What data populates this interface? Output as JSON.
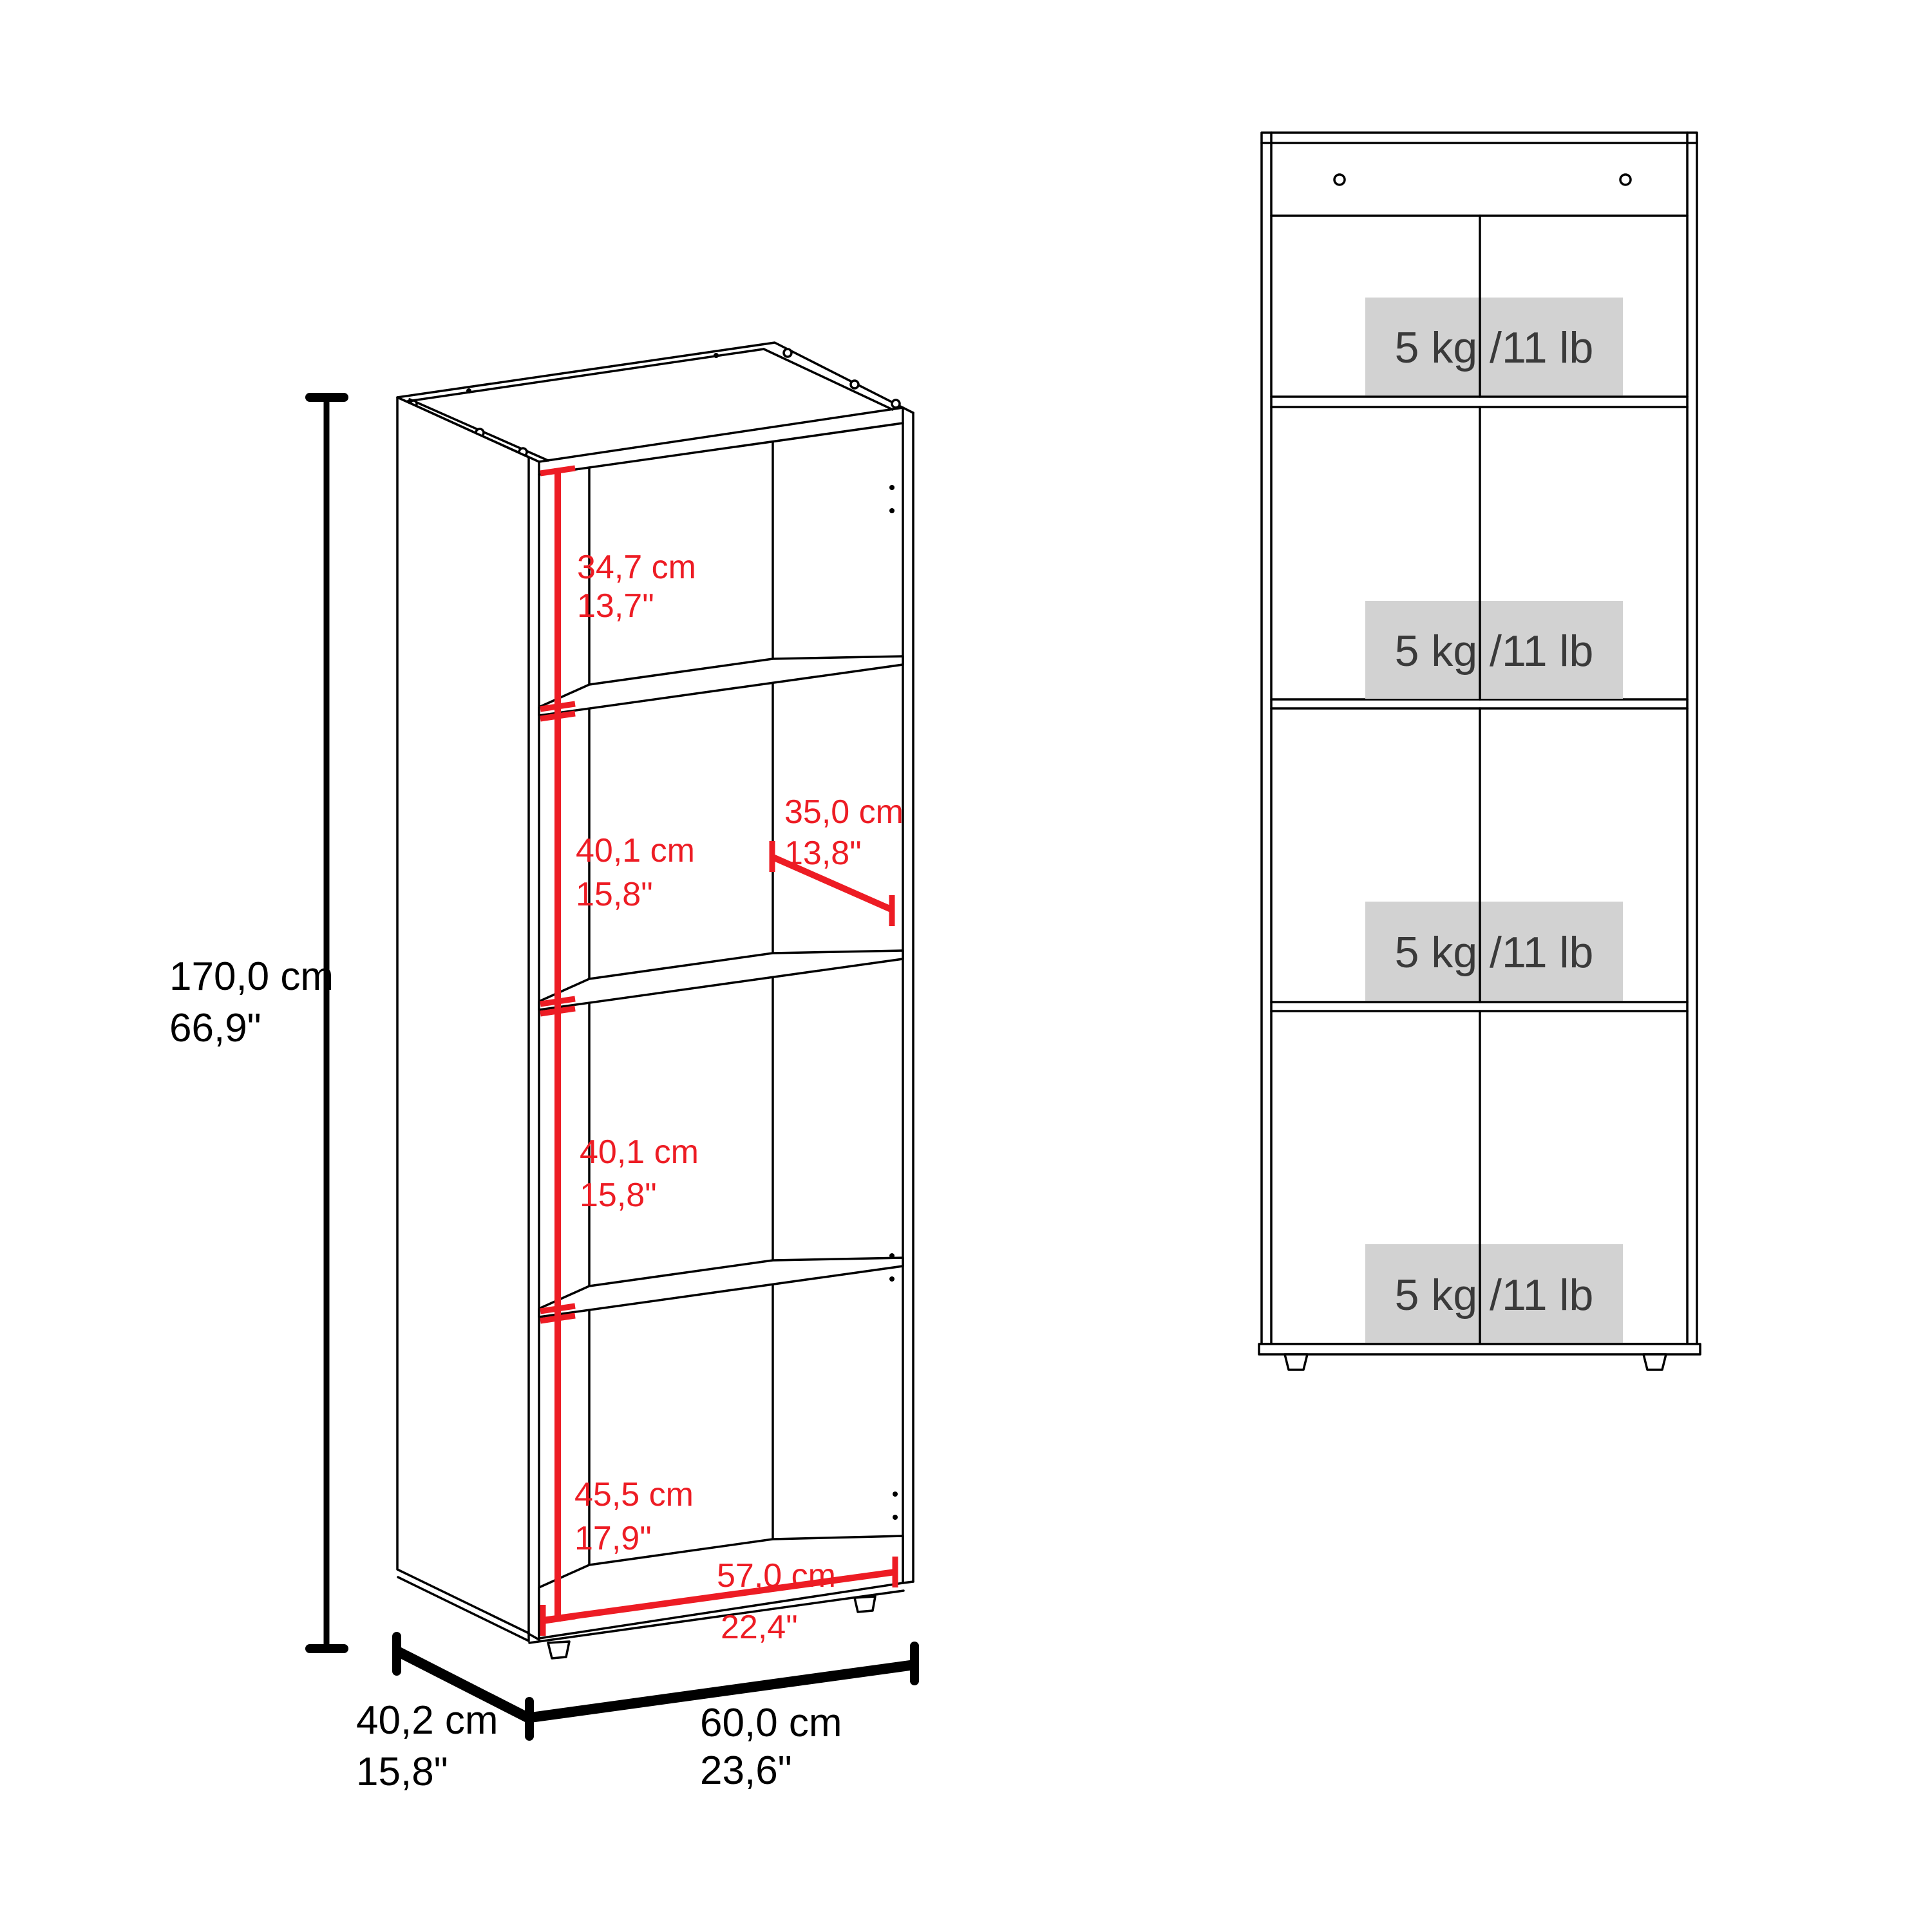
{
  "colors": {
    "accent_red": "#ed1c24",
    "line_black": "#000000",
    "load_box_gray": "#d2d2d2",
    "load_text_gray": "#3a3a3a",
    "background": "#ffffff"
  },
  "perspective_view": {
    "overall_height": {
      "cm": "170,0 cm",
      "inch": "66,9\""
    },
    "overall_depth": {
      "cm": "40,2 cm",
      "inch": "15,8\""
    },
    "overall_width": {
      "cm": "60,0 cm",
      "inch": "23,6\""
    },
    "compartment_heights": [
      {
        "cm": "34,7 cm",
        "inch": "13,7\""
      },
      {
        "cm": "40,1 cm",
        "inch": "15,8\""
      },
      {
        "cm": "40,1 cm",
        "inch": "15,8\""
      },
      {
        "cm": "45,5 cm",
        "inch": "17,9\""
      }
    ],
    "shelf_depth": {
      "cm": "35,0 cm",
      "inch": "13,8\""
    },
    "interior_width": {
      "cm": "57,0 cm",
      "inch": "22,4\""
    }
  },
  "front_view": {
    "shelves": [
      {
        "load": "5 kg /11 lb"
      },
      {
        "load": "5 kg /11 lb"
      },
      {
        "load": "5 kg /11 lb"
      },
      {
        "load": "5 kg /11 lb"
      }
    ]
  }
}
